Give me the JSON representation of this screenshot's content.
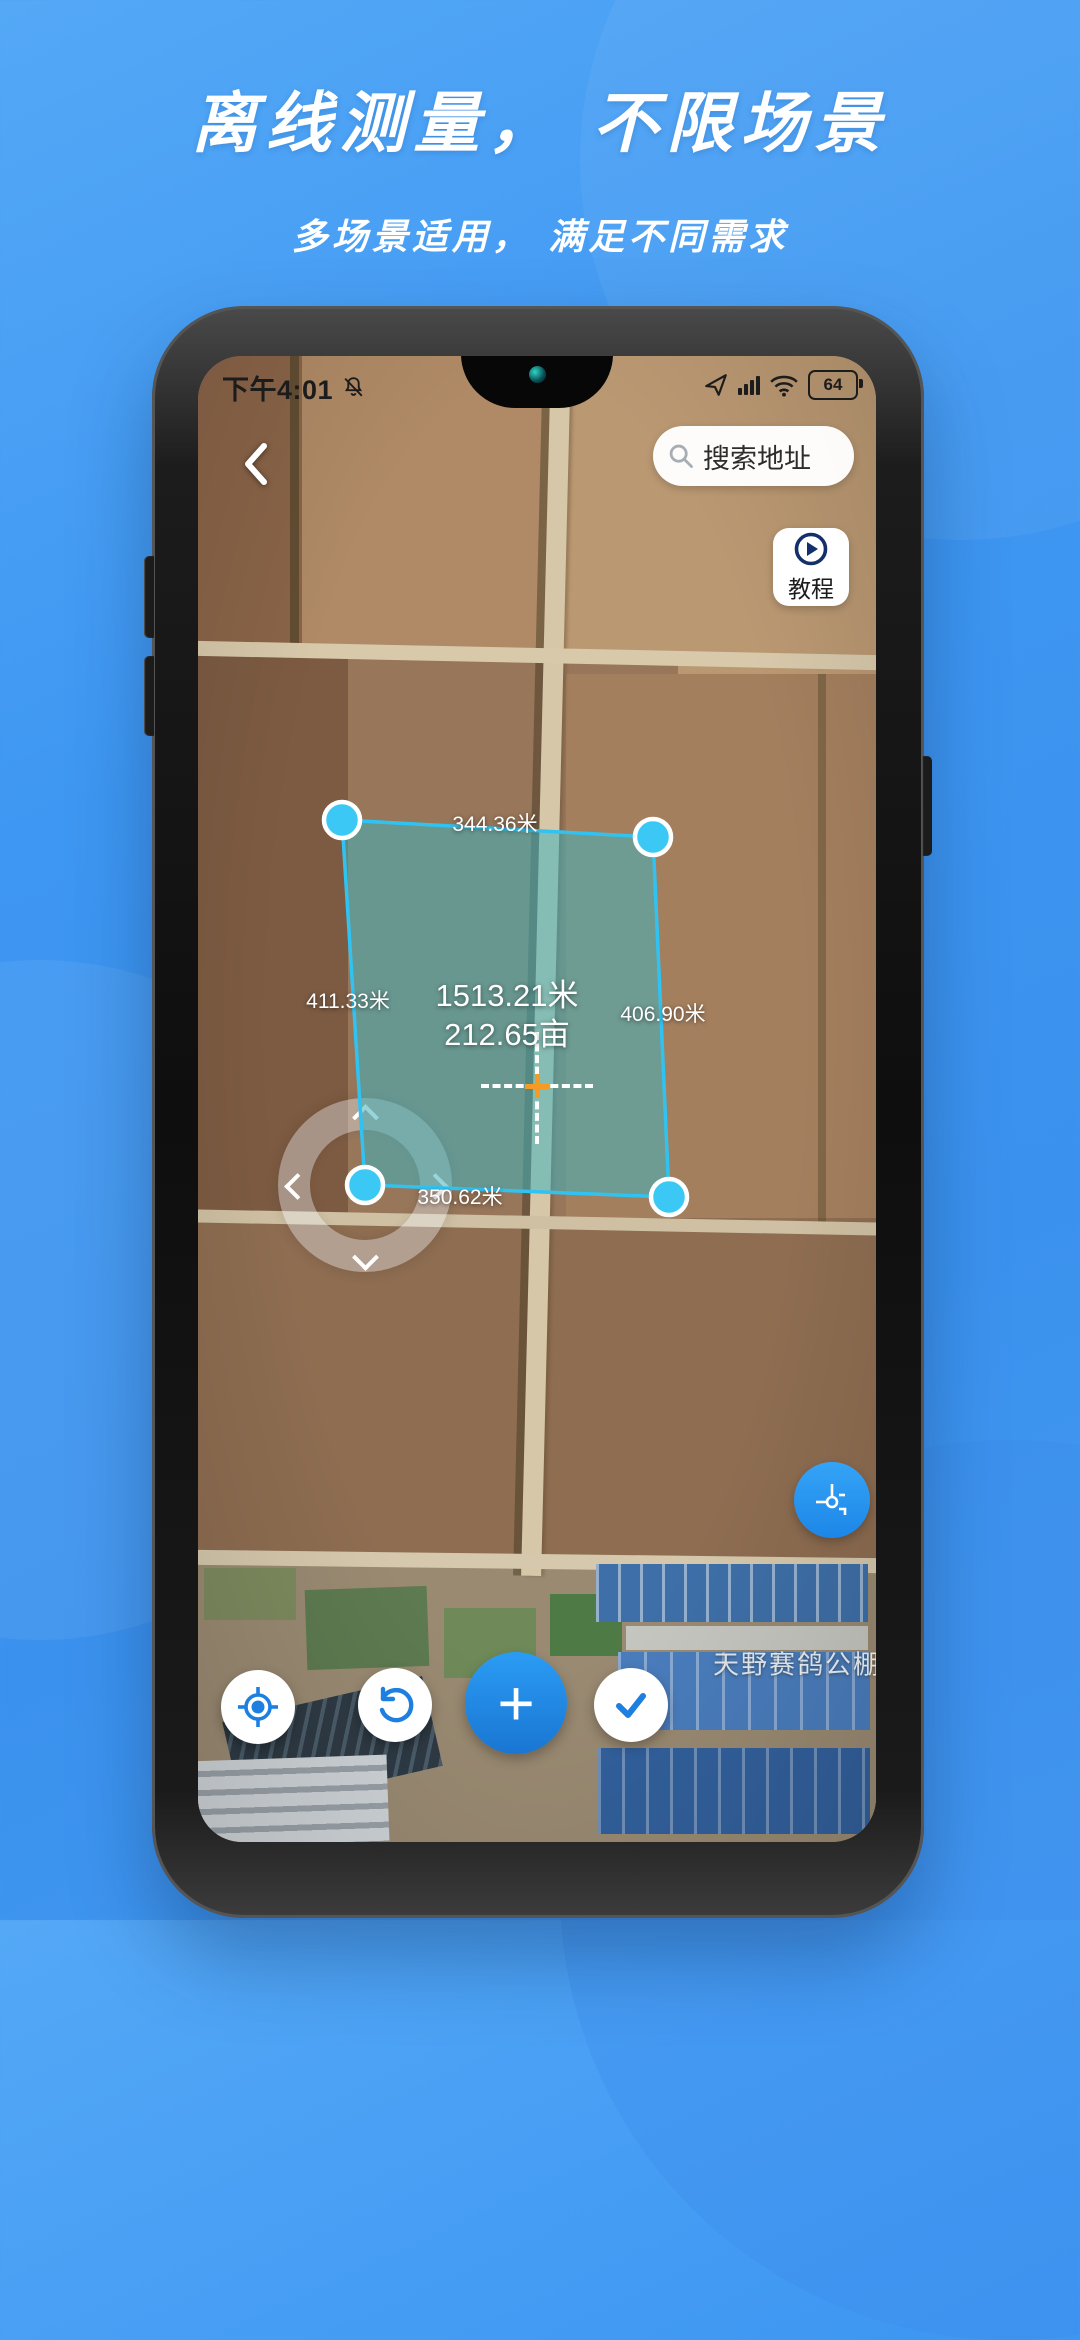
{
  "header": {
    "title": "离线测量， 不限场景",
    "subtitle": "多场景适用， 满足不同需求"
  },
  "phone": {
    "statusbar": {
      "time": "下午4:01",
      "battery_level": "64",
      "icons": [
        "mute-bell-icon",
        "nav-arrow-icon",
        "signal-bars-icon",
        "wifi-icon",
        "battery-icon"
      ]
    },
    "nav": {
      "back_icon": "chevron-left-icon",
      "search_placeholder": "搜索地址",
      "tutorial_label": "教程",
      "tutorial_icon": "play-circle-icon"
    },
    "measure": {
      "top_edge": "344.36米",
      "left_edge": "411.33米",
      "right_edge": "406.90米",
      "bottom_edge": "350.62米",
      "perimeter": "1513.21米",
      "area": "212.65亩"
    },
    "map": {
      "poi_label": "天野赛鸽公棚"
    },
    "buttons": {
      "plus_glyph": "+",
      "icons": [
        "locate-icon",
        "undo-icon",
        "plus-icon",
        "check-icon",
        "vertex-crosshair-icon"
      ]
    }
  },
  "colors": {
    "background_blue": "#3E97F2",
    "accent_blue": "#2196F3",
    "polygon_stroke": "#30C3F2",
    "polygon_fill": "rgba(66,178,190,0.55)",
    "crosshair_orange": "#F59A23"
  }
}
